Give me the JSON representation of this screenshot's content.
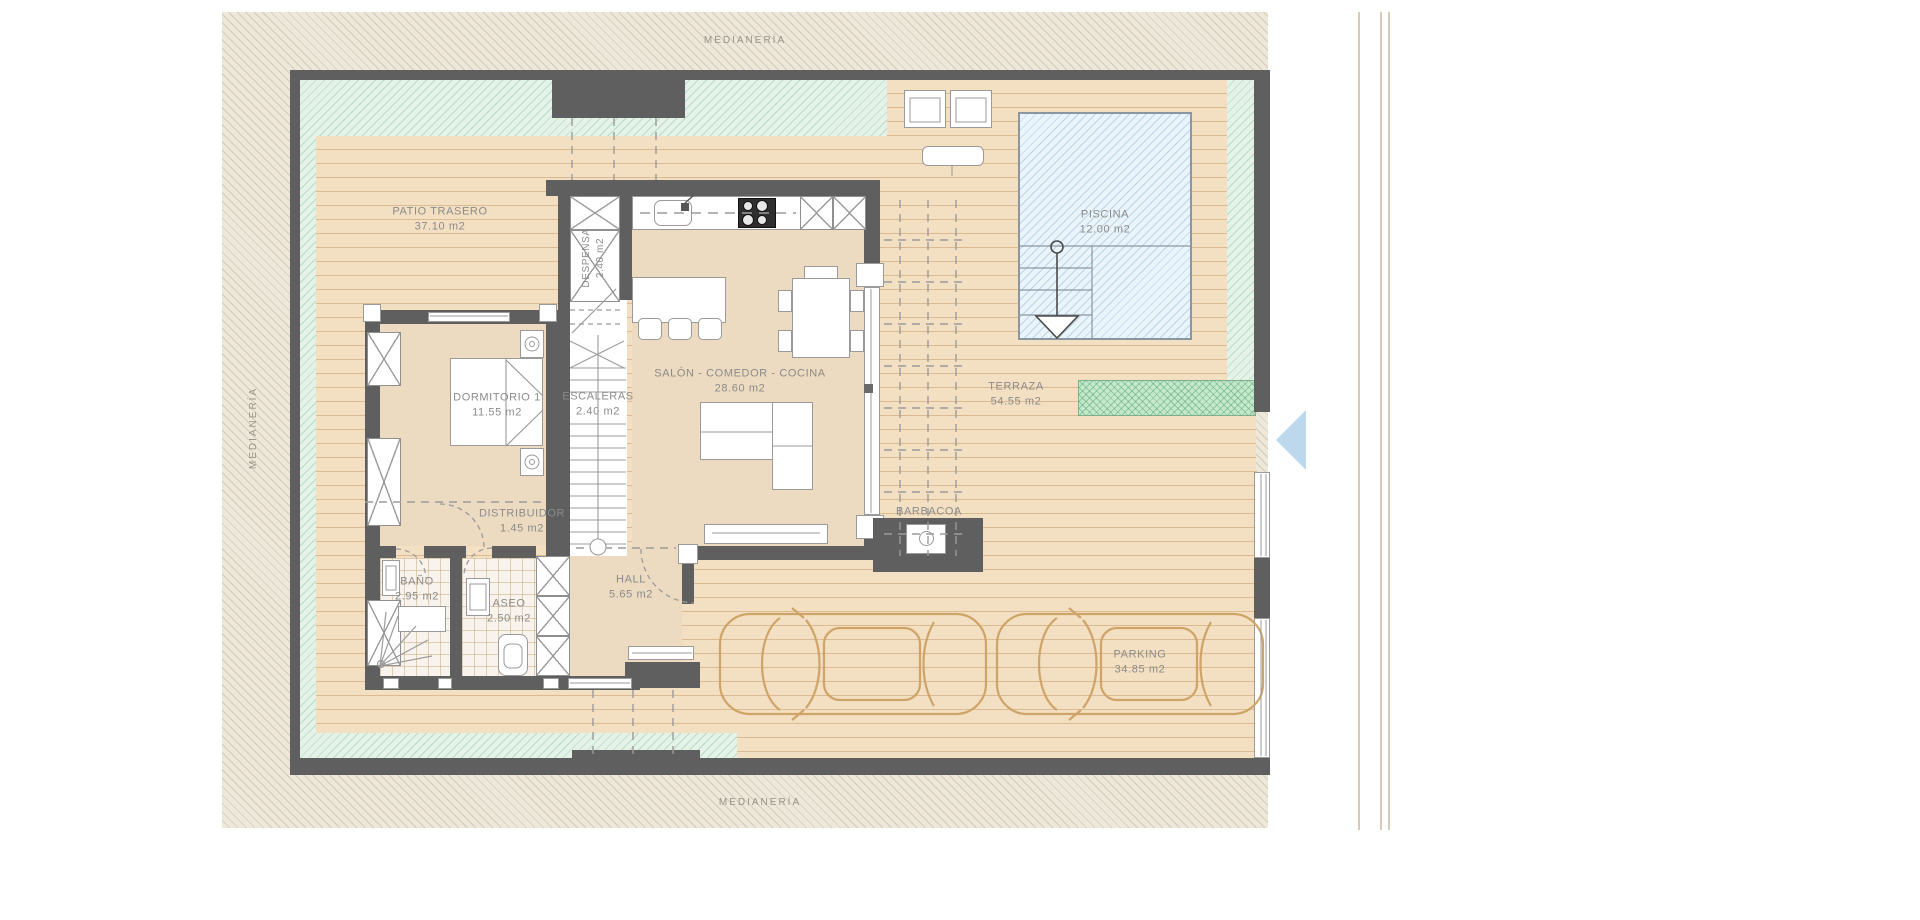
{
  "boundaries": {
    "top": "MEDIANERÍA",
    "left": "MEDIANERÍA",
    "bottom": "MEDIANERÍA"
  },
  "rooms": {
    "patio": {
      "name": "PATIO TRASERO",
      "area": "37.10 m2"
    },
    "piscina": {
      "name": "PISCINA",
      "area": "12.00 m2"
    },
    "dormitorio": {
      "name": "DORMITORIO 1",
      "area": "11.55 m2"
    },
    "escaleras": {
      "name": "ESCALERAS",
      "area": "2.40 m2"
    },
    "despensa": {
      "name": "DESPENSA",
      "area": "2.40 m2"
    },
    "salon": {
      "name": "SALÓN - COMEDOR - COCINA",
      "area": "28.60 m2"
    },
    "terraza": {
      "name": "TERRAZA",
      "area": "54.55 m2"
    },
    "distribuidor": {
      "name": "DISTRIBUIDOR",
      "area": "1.45 m2"
    },
    "bano": {
      "name": "BAÑO",
      "area": "2.95 m2"
    },
    "aseo": {
      "name": "ASEO",
      "area": "2.50 m2"
    },
    "hall": {
      "name": "HALL",
      "area": "5.65 m2"
    },
    "barbacoa": {
      "name": "BARBACOA",
      "area": ""
    },
    "parking": {
      "name": "PARKING",
      "area": "34.85 m2"
    }
  },
  "colors": {
    "wall": "#5f5f5f",
    "deck": "#f3dfc2",
    "plank_line": "#bb884e",
    "interior_floor": "#ecdbc1",
    "garden_strip": "#e4f2e8",
    "garden_hatch": "#78c092",
    "planter": "#c6e8cd",
    "pool_fill": "#eaf4fb",
    "pool_hatch": "#7aa2c8",
    "boundary_band": "#eee8db",
    "label_text": "#8b8b8b",
    "car_outline": "#cfa468",
    "entrance_arrow": "#bdd7ec"
  }
}
